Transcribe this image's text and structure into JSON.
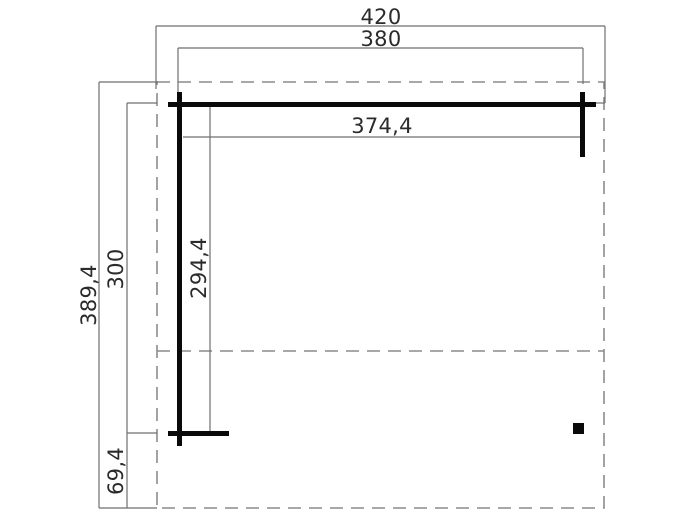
{
  "drawing": {
    "labels": {
      "overall_width": "420",
      "post_spacing": "380",
      "beam_length": "374,4",
      "overall_depth": "389,4",
      "side_depth": "300",
      "inner_depth": "294,4",
      "front_overhang": "69,4"
    },
    "colors": {
      "background": "#ffffff",
      "thin_line": "#6f6f6f",
      "dashed_line": "#8c8c8c",
      "thick_line": "#0a0a0a",
      "text": "#2b2b2b"
    }
  }
}
